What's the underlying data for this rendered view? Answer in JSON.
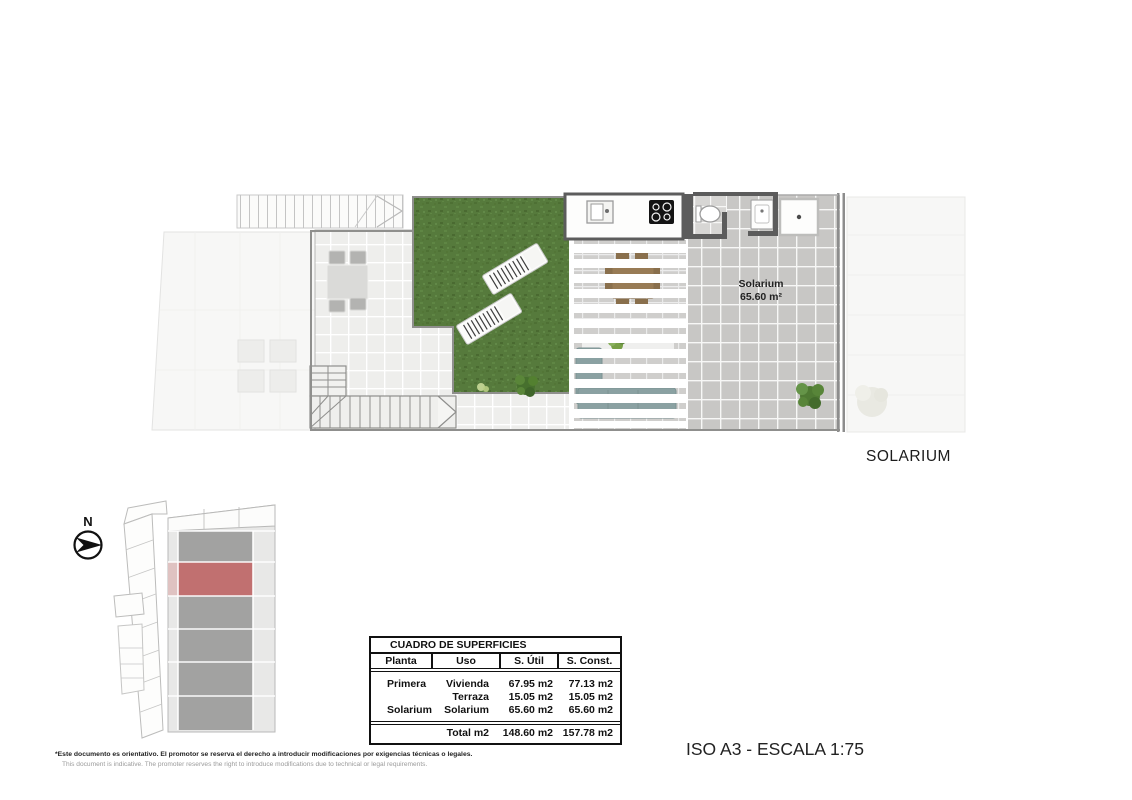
{
  "sheet": {
    "solarium_caption": "SOLARIUM",
    "scale_label": "ISO A3 - ESCALA 1:75",
    "north_label": "N",
    "disclaimer_line1": "*Este documento es orientativo. El promotor se reserva el derecho a introducir modificaciones por exigencias técnicas o legales.",
    "disclaimer_line2": "This document is indicative. The promoter reserves the right to introduce modifications due to technical or legal requirements."
  },
  "plan": {
    "room_label": {
      "name": "Solarium",
      "area": "65.60 m²"
    }
  },
  "surfaces_table": {
    "title": "CUADRO DE SUPERFICIES",
    "columns": [
      "Planta",
      "Uso",
      "S. Útil",
      "S. Const."
    ],
    "rows": [
      {
        "planta": "Primera",
        "uso": "Vivienda",
        "util": "67.95 m2",
        "construida": "77.13 m2"
      },
      {
        "planta": "",
        "uso": "Terraza",
        "util": "15.05 m2",
        "construida": "15.05 m2"
      },
      {
        "planta": "Solarium",
        "uso": "Solarium",
        "util": "65.60 m2",
        "construida": "65.60 m2"
      }
    ],
    "total": {
      "uso": "Total m2",
      "util": "148.60 m2",
      "construida": "157.78 m2"
    }
  },
  "colors": {
    "highlight_red": "#c17070",
    "grass_green": "#567a3c",
    "tile_light": "#ebebe9",
    "tile_mid": "#c8c7c5",
    "wall_dark": "#5c5c5c",
    "sofa_teal": "#8ba4a5",
    "wood_brown": "#9a7a50",
    "ink": "#1a1a1a"
  }
}
